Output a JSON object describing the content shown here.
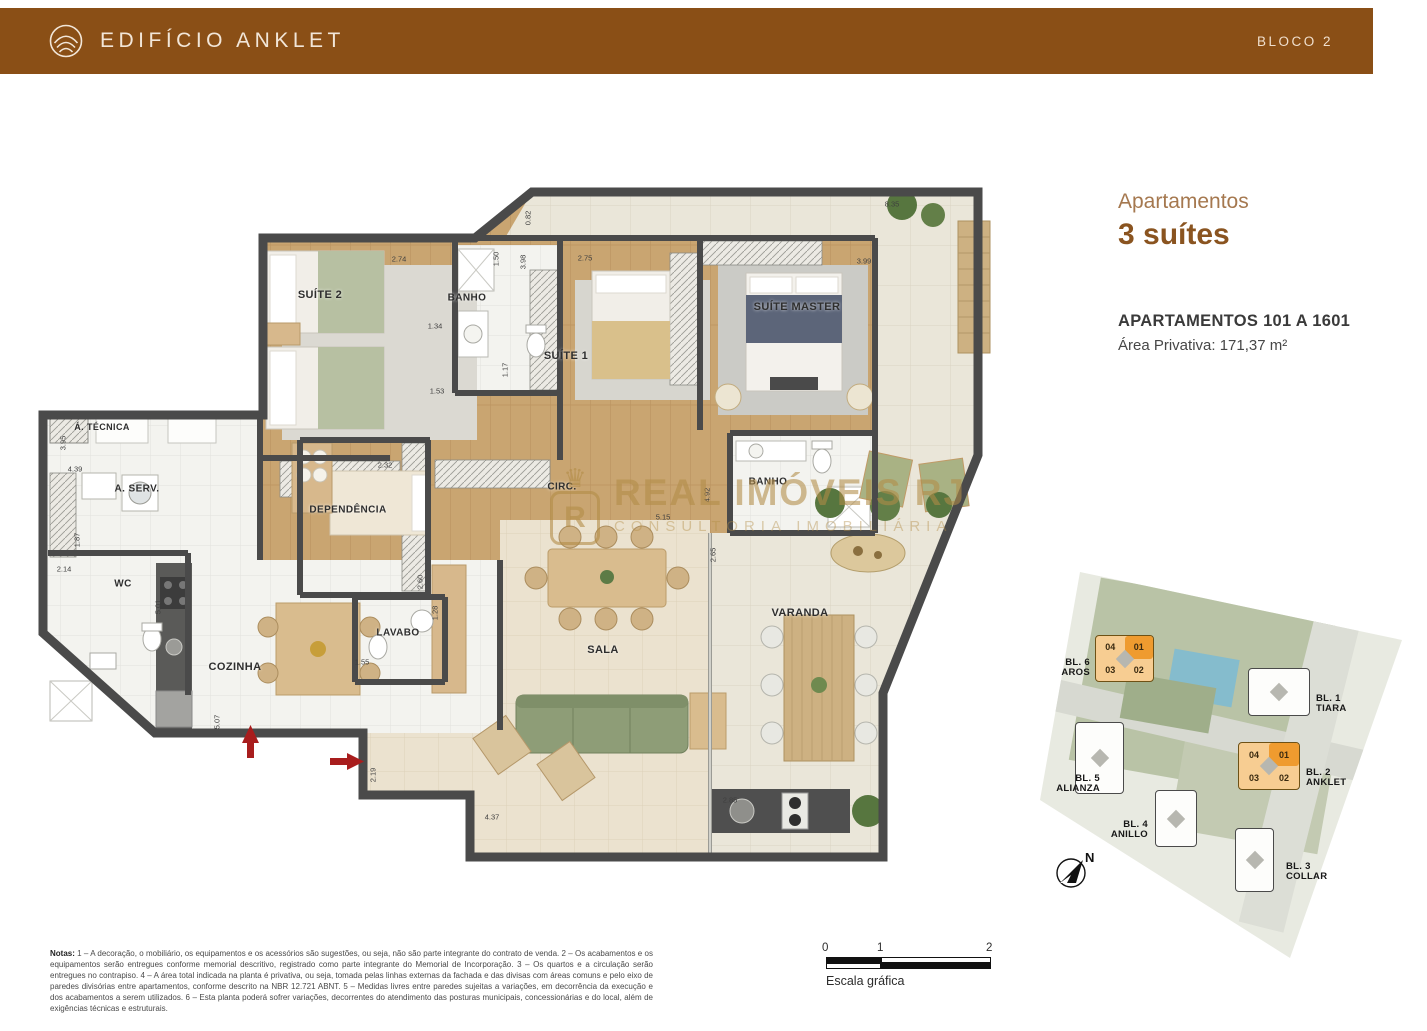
{
  "header": {
    "title": "EDIFÍCIO ANKLET",
    "block": "BLOCO 2"
  },
  "info": {
    "category": "Apartamentos",
    "headline": "3 suítes",
    "line1": "APARTAMENTOS 101 A 1601",
    "line2": "Área Privativa: 171,37 m²"
  },
  "watermark": {
    "crown": "♛",
    "badge_letter": "R",
    "line1": "REAL IMÓVEIS RJ",
    "line2": "CONSULTORIA IMOBILIÁRIA"
  },
  "plan": {
    "rooms": [
      {
        "id": "suite2",
        "label": "SUÍTE 2"
      },
      {
        "id": "banho1",
        "label": "BANHO"
      },
      {
        "id": "suite1",
        "label": "SUÍTE 1"
      },
      {
        "id": "suite-master",
        "label": "SUÍTE MASTER"
      },
      {
        "id": "banho2",
        "label": "BANHO"
      },
      {
        "id": "circ",
        "label": "CIRC."
      },
      {
        "id": "area-tecnica",
        "label": "Á. TÉCNICA"
      },
      {
        "id": "area-servico",
        "label": "A. SERV."
      },
      {
        "id": "wc",
        "label": "WC"
      },
      {
        "id": "cozinha",
        "label": "COZINHA"
      },
      {
        "id": "dependencia",
        "label": "DEPENDÊNCIA"
      },
      {
        "id": "lavabo",
        "label": "LAVABO"
      },
      {
        "id": "sala",
        "label": "SALA"
      },
      {
        "id": "varanda",
        "label": "VARANDA"
      }
    ],
    "dimensions": [
      {
        "value": "2.74"
      },
      {
        "value": "1.50"
      },
      {
        "value": "3.98"
      },
      {
        "value": "0.82"
      },
      {
        "value": "2.75"
      },
      {
        "value": "3.99"
      },
      {
        "value": "8.35"
      },
      {
        "value": "1.34"
      },
      {
        "value": "1.53"
      },
      {
        "value": "1.17"
      },
      {
        "value": "5.15"
      },
      {
        "value": "4.92"
      },
      {
        "value": "2.65"
      },
      {
        "value": "3.95"
      },
      {
        "value": "4.39"
      },
      {
        "value": "1.87"
      },
      {
        "value": "2.14"
      },
      {
        "value": "5.01"
      },
      {
        "value": "2.32"
      },
      {
        "value": "2.60"
      },
      {
        "value": "1.55"
      },
      {
        "value": "5.07"
      },
      {
        "value": "2.19"
      },
      {
        "value": "4.37"
      },
      {
        "value": "2.85"
      },
      {
        "value": "1.28"
      }
    ]
  },
  "site_plan": {
    "north": "N",
    "blocks": {
      "b6": {
        "line1": "BL. 6",
        "line2": "AROS",
        "units": [
          "04",
          "01",
          "03",
          "02"
        ]
      },
      "b1": {
        "line1": "BL. 1",
        "line2": "TIARA"
      },
      "b5": {
        "line1": "BL. 5",
        "line2": "ALIANZA"
      },
      "b2": {
        "line1": "BL. 2",
        "line2": "ANKLET",
        "units": [
          "04",
          "01",
          "03",
          "02"
        ]
      },
      "b4": {
        "line1": "BL. 4",
        "line2": "ANILLO"
      },
      "b3": {
        "line1": "BL. 3",
        "line2": "COLLAR"
      }
    }
  },
  "scale_bar": {
    "ticks": [
      "0",
      "1",
      "2"
    ],
    "label": "Escala gráfica"
  },
  "notes": {
    "label": "Notas:",
    "text": " 1 – A decoração, o mobiliário, os equipamentos e os acessórios são sugestões, ou seja, não são parte integrante do contrato de venda. 2 – Os acabamentos e os equipamentos serão entregues conforme memorial descritivo, registrado como parte integrante do Memorial de Incorporação. 3 – Os quartos e a circulação serão entregues no contrapiso. 4 – A área total indicada na planta é privativa, ou seja, tomada pelas linhas externas da fachada e das divisas com áreas comuns e pelo eixo de paredes divisórias entre apartamentos, conforme descrito na NBR 12.721 ABNT. 5 – Medidas livres entre paredes sujeitas a variações, em decorrência da execução e dos acabamentos a serem utilizados. 6 – Esta planta poderá sofrer variações, decorrentes do atendimento das posturas municipais, concessionárias e do local, além de exigências técnicas e estruturais."
  }
}
